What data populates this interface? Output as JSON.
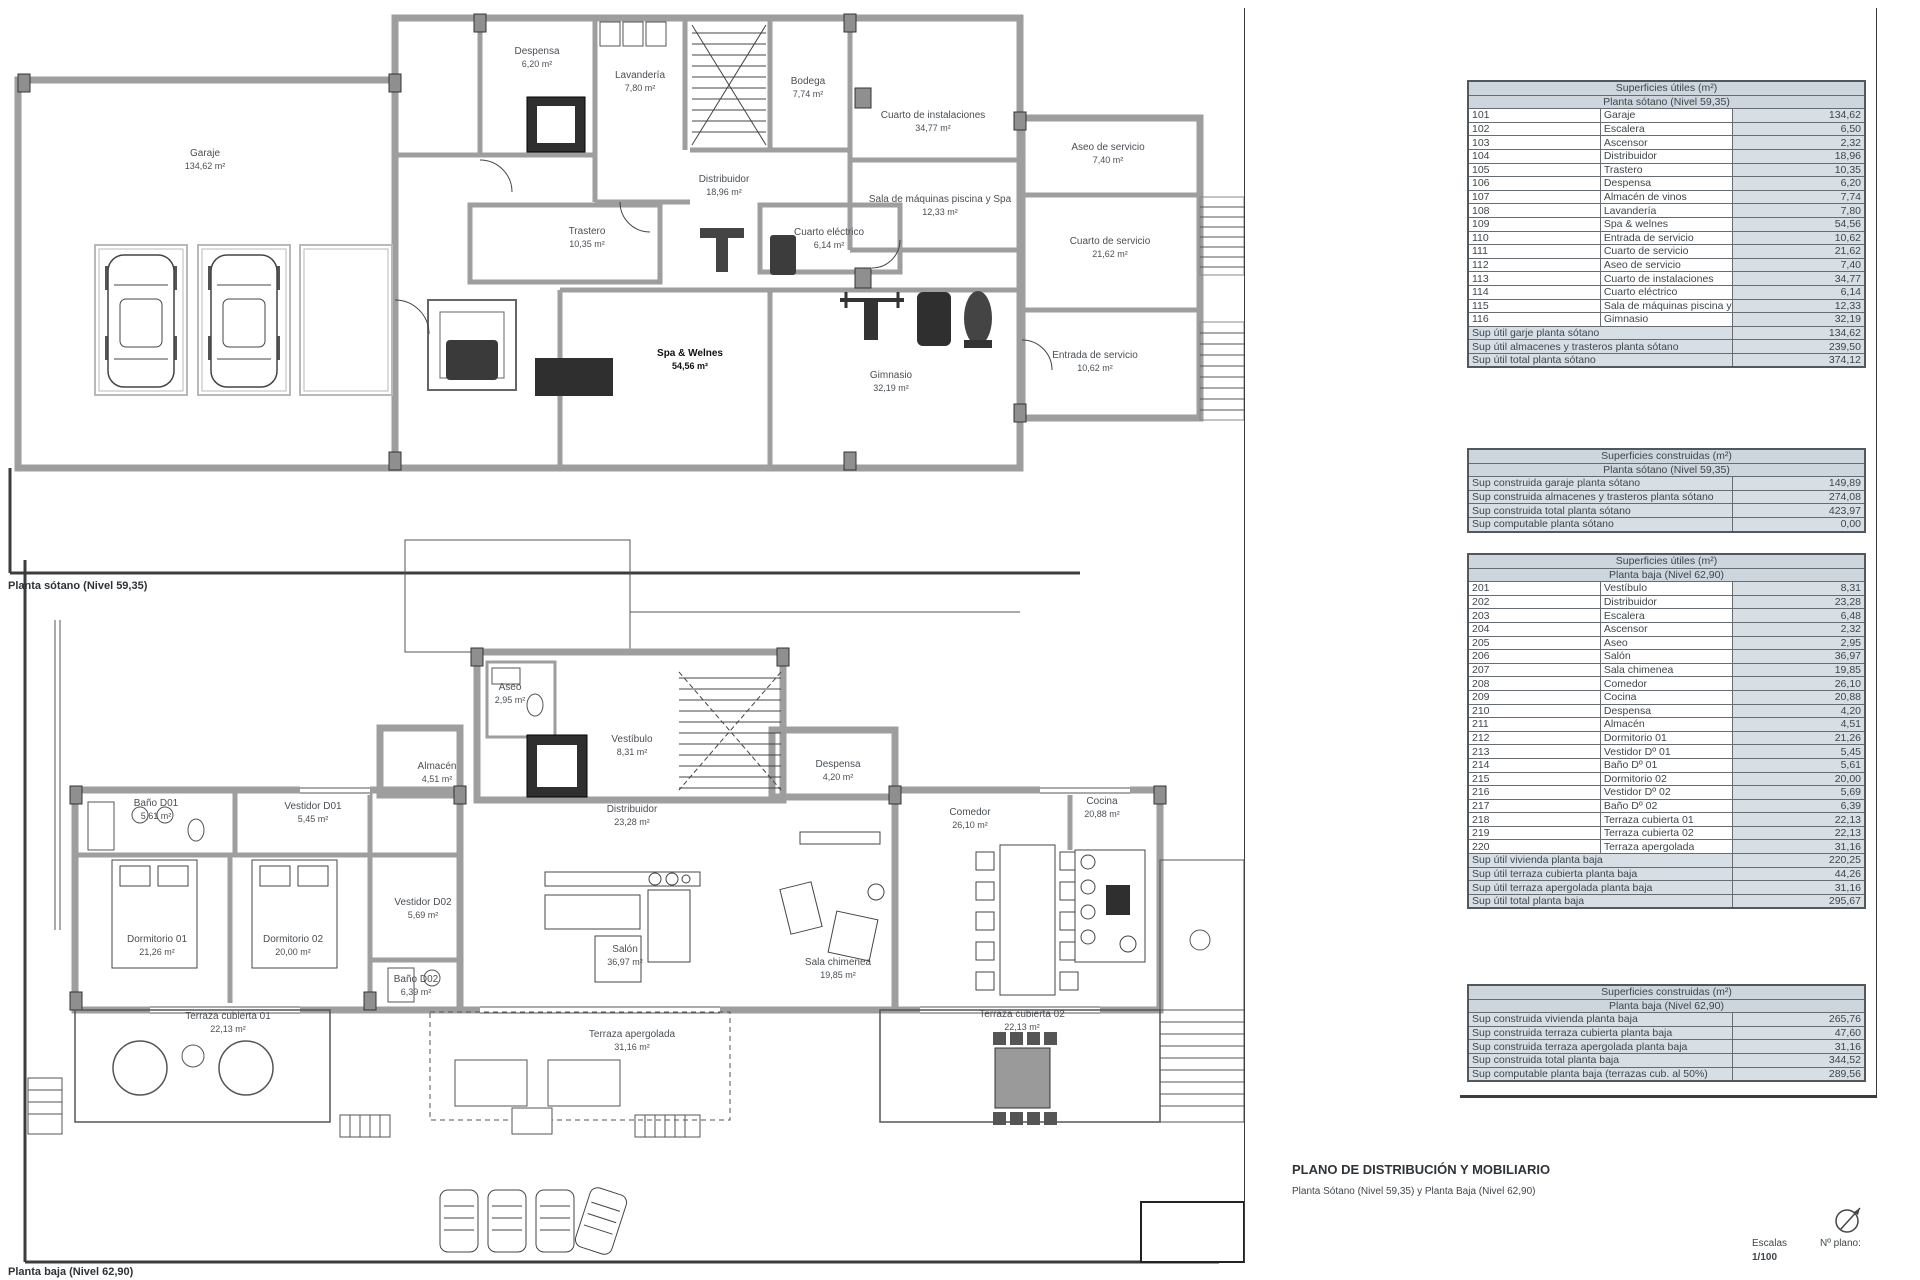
{
  "plans": {
    "sotano": {
      "caption": "Planta sótano (Nivel 59,35)",
      "rooms": [
        {
          "name": "Garaje",
          "area": "134,62 m²"
        },
        {
          "name": "Despensa",
          "area": "6,20 m²"
        },
        {
          "name": "Lavandería",
          "area": "7,80 m²"
        },
        {
          "name": "Bodega",
          "area": "7,74 m²"
        },
        {
          "name": "Cuarto de instalaciones",
          "area": "34,77 m²"
        },
        {
          "name": "Distribuidor",
          "area": "18,96 m²"
        },
        {
          "name": "Trastero",
          "area": "10,35 m²"
        },
        {
          "name": "Sala de máquinas piscina y Spa",
          "area": "12,33 m²"
        },
        {
          "name": "Cuarto eléctrico",
          "area": "6,14 m²"
        },
        {
          "name": "Aseo de servicio",
          "area": "7,40 m²"
        },
        {
          "name": "Cuarto de servicio",
          "area": "21,62 m²"
        },
        {
          "name": "Entrada de servicio",
          "area": "10,62 m²"
        },
        {
          "name": "Spa & Welnes",
          "area": "54,56 m²"
        },
        {
          "name": "Gimnasio",
          "area": "32,19 m²"
        }
      ]
    },
    "baja": {
      "caption": "Planta baja (Nivel 62,90)",
      "rooms": [
        {
          "name": "Aseo",
          "area": "2,95 m²"
        },
        {
          "name": "Vestíbulo",
          "area": "8,31 m²"
        },
        {
          "name": "Almacén",
          "area": "4,51 m²"
        },
        {
          "name": "Despensa",
          "area": "4,20 m²"
        },
        {
          "name": "Distribuidor",
          "area": "23,28 m²"
        },
        {
          "name": "Comedor",
          "area": "26,10 m²"
        },
        {
          "name": "Cocina",
          "area": "20,88 m²"
        },
        {
          "name": "Baño D01",
          "area": "5,61 m²"
        },
        {
          "name": "Vestidor D01",
          "area": "5,45 m²"
        },
        {
          "name": "Vestidor D02",
          "area": "5,69 m²"
        },
        {
          "name": "Dormitorio 01",
          "area": "21,26 m²"
        },
        {
          "name": "Dormitorio 02",
          "area": "20,00 m²"
        },
        {
          "name": "Baño D02",
          "area": "6,39 m²"
        },
        {
          "name": "Salón",
          "area": "36,97 m²"
        },
        {
          "name": "Sala chimenea",
          "area": "19,85 m²"
        },
        {
          "name": "Terraza cubierta 01",
          "area": "22,13 m²"
        },
        {
          "name": "Terraza apergolada",
          "area": "31,16 m²"
        },
        {
          "name": "Terraza cubierta 02",
          "area": "22,13 m²"
        }
      ]
    }
  },
  "tables": [
    {
      "title": "Superficies útiles (m²)",
      "subtitle": "Planta sótano (Nivel 59,35)",
      "rows": [
        [
          "101",
          "Garaje",
          "134,62"
        ],
        [
          "102",
          "Escalera",
          "6,50"
        ],
        [
          "103",
          "Ascensor",
          "2,32"
        ],
        [
          "104",
          "Distribuidor",
          "18,96"
        ],
        [
          "105",
          "Trastero",
          "10,35"
        ],
        [
          "106",
          "Despensa",
          "6,20"
        ],
        [
          "107",
          "Almacén de vinos",
          "7,74"
        ],
        [
          "108",
          "Lavandería",
          "7,80"
        ],
        [
          "109",
          "Spa & welnes",
          "54,56"
        ],
        [
          "110",
          "Entrada de servicio",
          "10,62"
        ],
        [
          "111",
          "Cuarto de servicio",
          "21,62"
        ],
        [
          "112",
          "Aseo de servicio",
          "7,40"
        ],
        [
          "113",
          "Cuarto de instalaciones",
          "34,77"
        ],
        [
          "114",
          "Cuarto eléctrico",
          "6,14"
        ],
        [
          "115",
          "Sala de máquinas piscina y spa",
          "12,33"
        ],
        [
          "116",
          "Gimnasio",
          "32,19"
        ]
      ],
      "totals": [
        [
          "Sup útil garje planta sótano",
          "134,62"
        ],
        [
          "Sup útil almacenes y trasteros planta sótano",
          "239,50"
        ],
        [
          "Sup útil total planta sótano",
          "374,12"
        ]
      ]
    },
    {
      "title": "Superficies construidas (m²)",
      "subtitle": "Planta sótano (Nivel 59,35)",
      "rows": [],
      "totals": [
        [
          "Sup construida garaje planta sótano",
          "149,89"
        ],
        [
          "Sup construida almacenes y trasteros planta sótano",
          "274,08"
        ],
        [
          "Sup construida total planta sótano",
          "423,97"
        ],
        [
          "Sup computable planta sótano",
          "0,00"
        ]
      ]
    },
    {
      "title": "Superficies útiles (m²)",
      "subtitle": "Planta baja (Nivel 62,90)",
      "rows": [
        [
          "201",
          "Vestíbulo",
          "8,31"
        ],
        [
          "202",
          "Distribuidor",
          "23,28"
        ],
        [
          "203",
          "Escalera",
          "6,48"
        ],
        [
          "204",
          "Ascensor",
          "2,32"
        ],
        [
          "205",
          "Aseo",
          "2,95"
        ],
        [
          "206",
          "Salón",
          "36,97"
        ],
        [
          "207",
          "Sala chimenea",
          "19,85"
        ],
        [
          "208",
          "Comedor",
          "26,10"
        ],
        [
          "209",
          "Cocina",
          "20,88"
        ],
        [
          "210",
          "Despensa",
          "4,20"
        ],
        [
          "211",
          "Almacén",
          "4,51"
        ],
        [
          "212",
          "Dormitorio 01",
          "21,26"
        ],
        [
          "213",
          "Vestidor Dº 01",
          "5,45"
        ],
        [
          "214",
          "Baño Dº 01",
          "5,61"
        ],
        [
          "215",
          "Dormitorio 02",
          "20,00"
        ],
        [
          "216",
          "Vestidor Dº 02",
          "5,69"
        ],
        [
          "217",
          "Baño Dº 02",
          "6,39"
        ],
        [
          "218",
          "Terraza cubierta 01",
          "22,13"
        ],
        [
          "219",
          "Terraza cubierta 02",
          "22,13"
        ],
        [
          "220",
          "Terraza apergolada",
          "31,16"
        ]
      ],
      "totals": [
        [
          "Sup útil vivienda planta baja",
          "220,25"
        ],
        [
          "Sup útil terraza cubierta planta baja",
          "44,26"
        ],
        [
          "Sup útil terraza apergolada planta baja",
          "31,16"
        ],
        [
          "Sup útil total planta baja",
          "295,67"
        ]
      ]
    },
    {
      "title": "Superficies construidas (m²)",
      "subtitle": "Planta baja (Nivel 62,90)",
      "rows": [],
      "totals": [
        [
          "Sup construida vivienda planta baja",
          "265,76"
        ],
        [
          "Sup construida terraza cubierta planta baja",
          "47,60"
        ],
        [
          "Sup construida terraza apergolada planta baja",
          "31,16"
        ],
        [
          "Sup construida total planta baja",
          "344,52"
        ],
        [
          "Sup computable planta baja (terrazas cub. al 50%)",
          "289,56"
        ]
      ]
    }
  ],
  "titleblock": {
    "title": "PLANO DE DISTRIBUCIÓN Y MOBILIARIO",
    "subtitle": "Planta Sótano (Nivel 59,35) y Planta Baja (Nivel 62,90)",
    "escalas_label": "Escalas",
    "escala_value": "1/100",
    "nplano_label": "Nº plano:"
  }
}
